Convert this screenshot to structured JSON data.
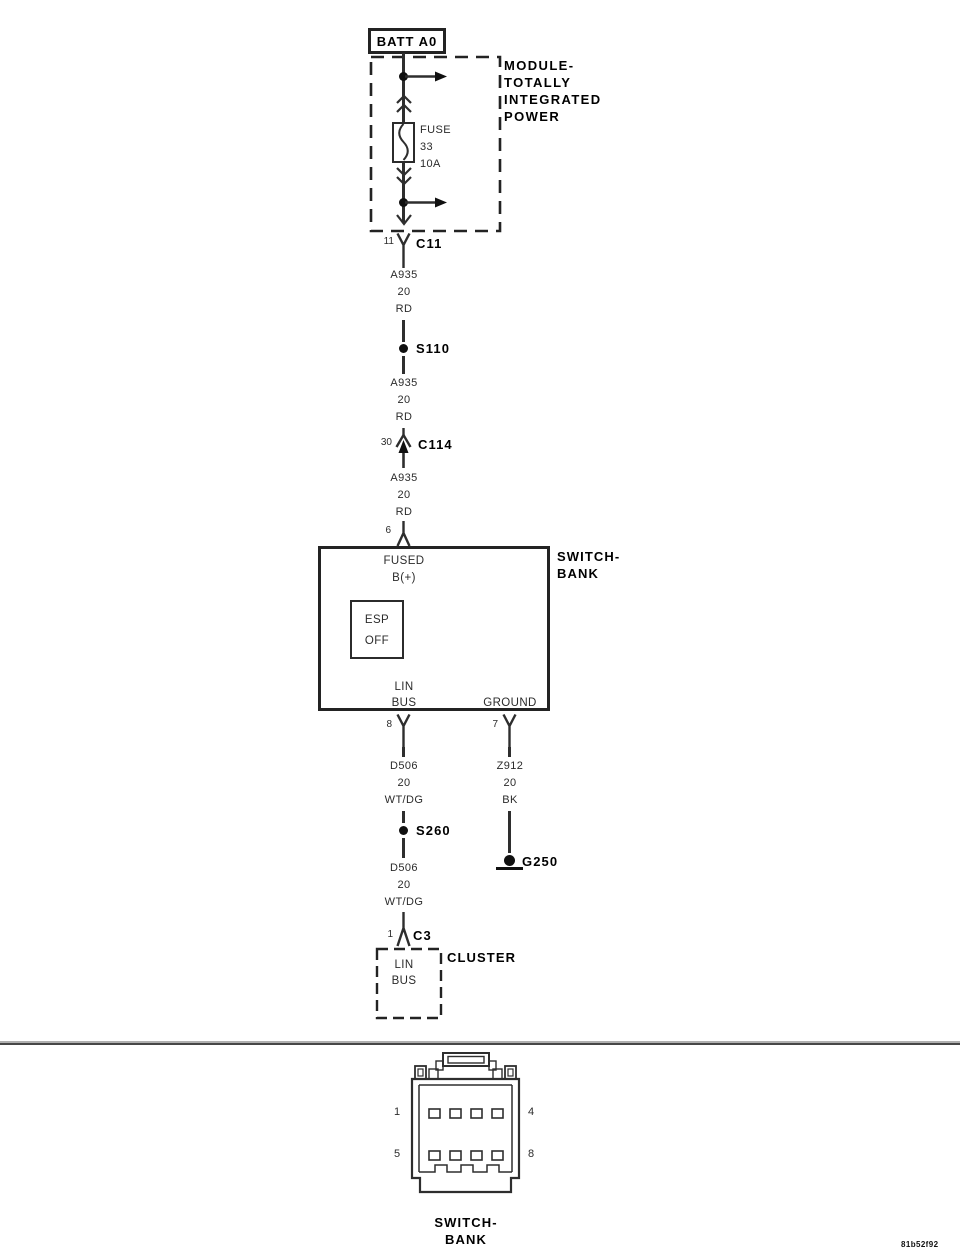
{
  "colors": {
    "line": "#2e2e2e",
    "bold_text": "#000000",
    "background": "#ffffff"
  },
  "battery": {
    "label": "BATT A0"
  },
  "tipm": {
    "name": [
      "MODULE-",
      "TOTALLY",
      "INTEGRATED",
      "POWER"
    ],
    "fuse": {
      "label": "FUSE",
      "number": "33",
      "rating": "10A"
    }
  },
  "c11": {
    "pin": "11",
    "label": "C11"
  },
  "wire_a935_1": {
    "circuit": "A935",
    "gauge": "20",
    "color": "RD"
  },
  "s110": {
    "label": "S110"
  },
  "wire_a935_2": {
    "circuit": "A935",
    "gauge": "20",
    "color": "RD"
  },
  "c114": {
    "pin": "30",
    "label": "C114"
  },
  "wire_a935_3": {
    "circuit": "A935",
    "gauge": "20",
    "color": "RD"
  },
  "switch_bank": {
    "pin_in": "6",
    "name": [
      "SWITCH-",
      "BANK"
    ],
    "fused_b": [
      "FUSED",
      "B(+)"
    ],
    "esp_off": [
      "ESP",
      "OFF"
    ],
    "lin_bus": [
      "LIN",
      "BUS"
    ],
    "ground": "GROUND",
    "pin_lin_bus": "8",
    "pin_ground": "7"
  },
  "wire_d506_1": {
    "circuit": "D506",
    "gauge": "20",
    "color": "WT/DG"
  },
  "wire_z912": {
    "circuit": "Z912",
    "gauge": "20",
    "color": "BK"
  },
  "s260": {
    "label": "S260"
  },
  "g250": {
    "label": "G250"
  },
  "wire_d506_2": {
    "circuit": "D506",
    "gauge": "20",
    "color": "WT/DG"
  },
  "c3": {
    "pin": "1",
    "label": "C3"
  },
  "cluster": {
    "name": "CLUSTER",
    "lin_bus": [
      "LIN",
      "BUS"
    ]
  },
  "connector_view": {
    "pin_top_left": "1",
    "pin_top_right": "4",
    "pin_bottom_left": "5",
    "pin_bottom_right": "8",
    "name": [
      "SWITCH-",
      "BANK"
    ]
  },
  "footer": {
    "code": "81b52f92"
  }
}
